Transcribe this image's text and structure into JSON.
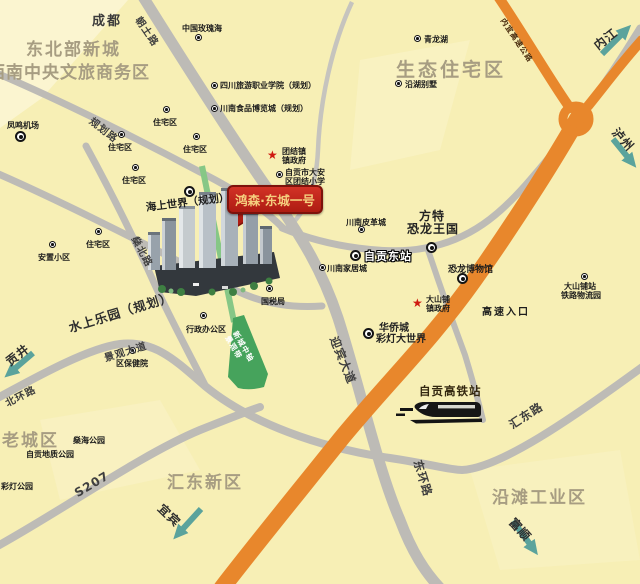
{
  "regions": {
    "northeast_new_city": "东北部新城",
    "cbd": "西南中央文旅商务区",
    "eco_residential": "生态住宅区",
    "old_town": "老城区",
    "huidong_new_district": "汇东新区",
    "yantan_industrial": "沿滩工业区"
  },
  "cities": {
    "chengdu": "成都",
    "neijiang": "内江",
    "luzhou": "泸州",
    "gongjing": "贡井",
    "yibin": "宜宾",
    "fushun": "富顺"
  },
  "roads": {
    "chaotu": "朝土路",
    "guihua": "规划路",
    "shenbei": "燊北路",
    "beihuan": "北环路",
    "jingguan_avenue": "景观大道",
    "s207": "S207",
    "yingbin_avenue": "迎宾大道",
    "donghuan": "东环路",
    "huidong_road": "汇东路",
    "neiyi_expressway": "内宜高速公路",
    "expressway_entrance": "高速入口"
  },
  "stations": {
    "zigong_east": "自贡东站",
    "zigong_hsr": "自贡高铁站"
  },
  "project": {
    "banner": "鸿森·东城一号",
    "axis": [
      "新城中轴",
      "景观带"
    ]
  },
  "pois": {
    "rose_sea": "中国玫瑰海",
    "tourism_college": "四川旅游职业学院（规划）",
    "food_expo": "川南食品博览城（规划）",
    "qinglong_lake": "青龙湖",
    "lakeside_villas": "沿湖别墅",
    "residential": "住宅区",
    "resettlement": "安置小区",
    "fengming_airport": "凤鸣机场",
    "tuanjie_gov": [
      "团结镇",
      "镇政府"
    ],
    "tuanjie_school": [
      "自贡市大安",
      "区团结小学"
    ],
    "sea_world": "海上世界（规划）",
    "water_park": "水上乐园（规划）",
    "leather_city": "川南皮革城",
    "fantawild": [
      "方特",
      "恐龙王国"
    ],
    "home_city": "川南家居城",
    "dino_museum": "恐龙博物馆",
    "dashanpu_gov": [
      "大山铺",
      "镇政府"
    ],
    "dashanpu_logistics": [
      "大山铺站",
      "铁路物流园"
    ],
    "oct_lantern_world": [
      "华侨城",
      "彩灯大世界"
    ],
    "tax_bureau": "国税局",
    "admin_office_area": "行政办公区",
    "health_center": "区保健院",
    "shenhai_park": "燊海公园",
    "geo_park": "自贡地质公园",
    "lantern_park": "彩灯公园"
  },
  "colors": {
    "background": "#F7EFB5",
    "highway_orange": "#E8872C",
    "road_gray": "#BDBBB6",
    "banner_red": "#C0261C",
    "banner_gold": "#F5CF7E",
    "axis_green": "#46A35C",
    "arrow_teal": "#5BA39C"
  }
}
